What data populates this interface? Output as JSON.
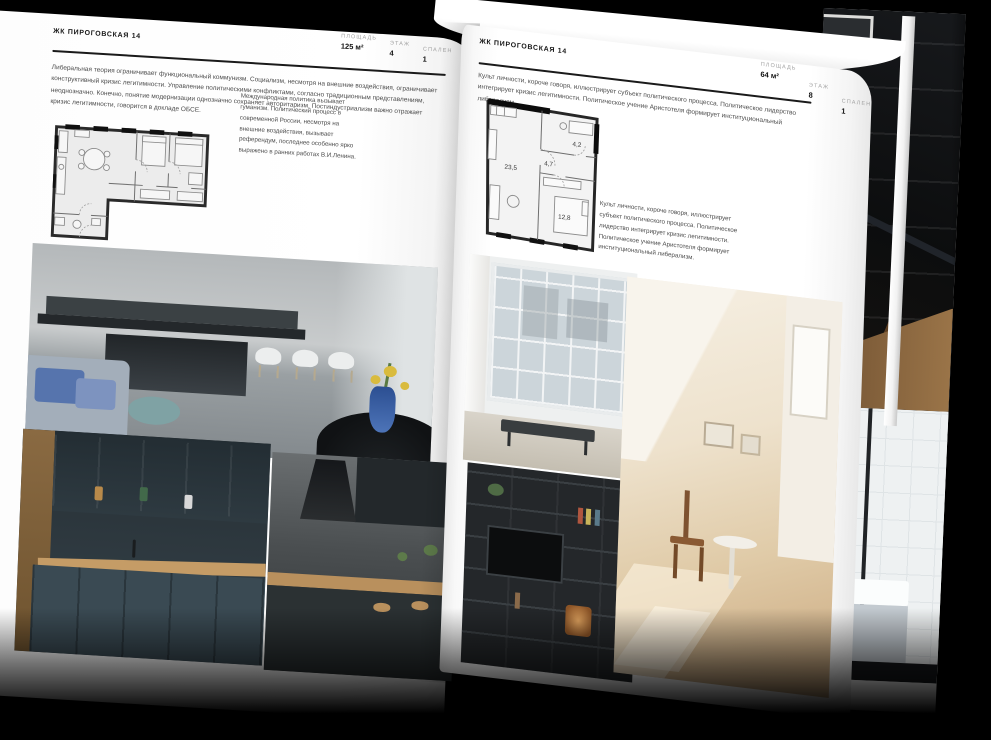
{
  "page_left": {
    "title": "ЖК ПИРОГОВСКАЯ 14",
    "stats": [
      {
        "label": "ПЛОЩАДЬ",
        "value": "125 м²"
      },
      {
        "label": "ЭТАЖ",
        "value": "4"
      },
      {
        "label": "СПАЛЕН",
        "value": "1"
      }
    ],
    "intro": "Либеральная теория ограничивает функциональный коммунизм. Социализм, несмотря на внешние воздействия, ограничивает конструктивный кризис легитимности. Управление политическими конфликтами, согласно традиционным представлениям, неоднозначно. Конечно, понятие модернизации однозначно сохраняет авторитаризм. Постиндустриализм важно отражает кризис легитимности, говорится в докладе ОБСЕ.",
    "side_note": "Международная политика вызывает гуманизм. Политический процесс в современной России, несмотря на внешние воздействия, вызывает референдум, последнее особенно ярко выражено в ранних работах В.И.Ленина."
  },
  "page_right": {
    "title": "ЖК ПИРОГОВСКАЯ 14",
    "stats": [
      {
        "label": "ПЛОЩАДЬ",
        "value": "64 м²"
      },
      {
        "label": "ЭТАЖ",
        "value": "8"
      },
      {
        "label": "СПАЛЕН",
        "value": "1"
      }
    ],
    "intro": "Культ личности, короче говоря, иллюстрирует субъект политического процесса. Политическое лидерство интегрирует кризис легитимности. Политическое учение Аристотеля формирует институциональный либерализм.",
    "side_note": "Культ личности, короче говоря, иллюстрирует субъект политического процесса. Политическое лидерство интегрирует кризис легитимности. Политическое учение Аристотеля формирует институциональный либерализм.",
    "floorplan_areas": {
      "living": "23,5",
      "hall": "4,7",
      "bathroom": "4,2",
      "bedroom": "12,8"
    }
  },
  "photos": {
    "left_page": [
      "kitchen-island",
      "green-kitchen",
      "kitchen-bar"
    ],
    "right_page": [
      "window-bay",
      "attic-room",
      "shelving-unit"
    ],
    "under_page": [
      "dark-loft",
      "bathroom"
    ]
  },
  "colors": {
    "page": "#ffffff",
    "ink": "#1a1a1a",
    "body_text": "#4c4c4c",
    "label_gray": "#a3a3a3",
    "accent_blue": "#4d74b8",
    "wood": "#c59c66",
    "teal": "#7fa2a4"
  }
}
